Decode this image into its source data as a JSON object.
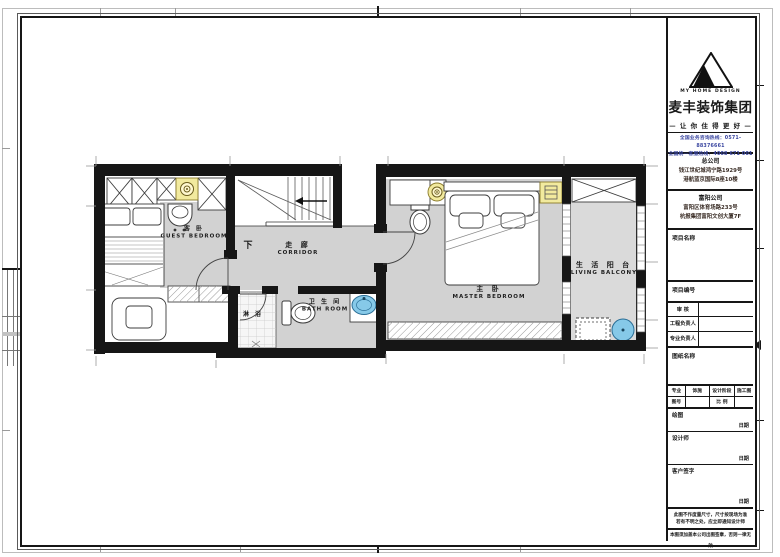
{
  "titleblock": {
    "brand": {
      "logo_text": "MY HOME DESIGN",
      "company": "麦丰装饰集团",
      "slogan": "— 让 你 住 得 更 好 —",
      "hotline1": "全国业务咨询热线：0571-88376661",
      "hotline2": "全国统一客服热线：4008 671 001"
    },
    "head_office": {
      "title": "总公司",
      "addr1": "钱江世纪城鸿宁路1929号",
      "addr2": "港航蓝京国际8座10楼"
    },
    "branch_office": {
      "title": "富阳公司",
      "addr1": "富阳区体育场路233号",
      "addr2": "杭报集团富阳文创大厦7F"
    },
    "project_name_label": "项目名称",
    "project_no_label": "项目编号",
    "review_label": "审 核",
    "project_manager_label": "工程负责人",
    "professional_manager_label": "专业负责人",
    "drawing_name_label": "图纸名称",
    "spec": {
      "major_label": "专业",
      "major_value": "饰施",
      "stage_label": "设计阶段",
      "stage_value": "施工图",
      "no_label": "图号",
      "no_value": "",
      "scale_label": "比 例",
      "scale_value": ""
    },
    "sign": {
      "draftsman_label": "绘图",
      "designer_label": "设计师",
      "client_label": "客户签字",
      "date_label": "日期"
    },
    "notes": {
      "line1": "此图不作度量尺寸，尺寸按现场为准",
      "line2": "若有不明之处，应立即通知设计师",
      "stamp": "本图须加盖本公司出图签章，否则一律无效"
    }
  },
  "plan": {
    "rooms": {
      "guest_bedroom": {
        "zh": "客 卧",
        "en": "GUEST BEDROOM"
      },
      "corridor": {
        "zh": "走 廊",
        "en": "CORRIDOR"
      },
      "shower": {
        "zh": "淋 浴"
      },
      "bathroom": {
        "zh": "卫 生 间",
        "en": "BATH ROOM"
      },
      "master_bedroom": {
        "zh": "主 卧",
        "en": "MASTER BEDROOM"
      },
      "living_balcony": {
        "zh": "生 活 阳 台",
        "en": "LIVING BALCONY"
      },
      "stairs_down": {
        "zh": "下"
      }
    },
    "colors": {
      "floor_gray": "#d2d2d2",
      "wall_black": "#161616",
      "highlight_yellow": "#f2ea9e",
      "basin_blue": "#86c9e8"
    }
  }
}
